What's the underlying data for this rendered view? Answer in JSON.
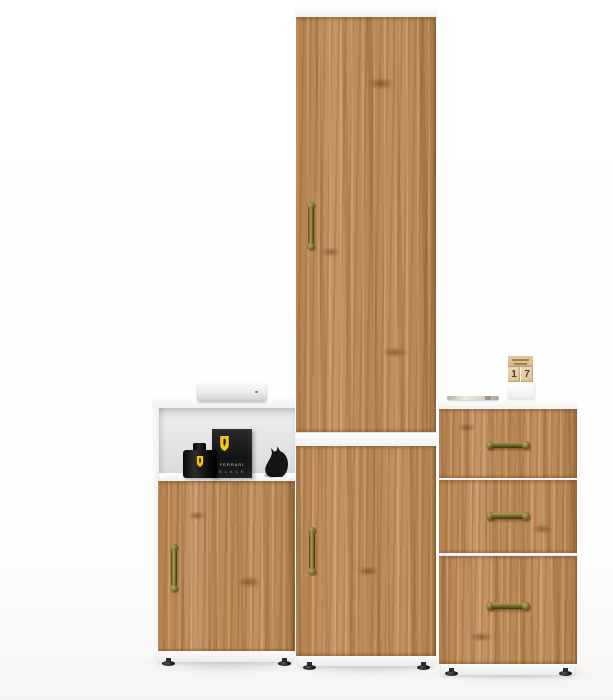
{
  "scene": {
    "description": "Product render of a three-piece golden-oak and white hallway furniture set on a white studio background"
  },
  "palette": {
    "wood_mid": "#b5834e",
    "wood_light": "#c69465",
    "wood_dark": "#8f6539",
    "frame_white": "#f8f8f8",
    "brass_handle": "#6e6226",
    "prop_black": "#141414",
    "shield_yellow": "#f6c60d",
    "background": "#fefefe"
  },
  "furniture": {
    "tall_cabinet": {
      "name": "tall two-door wardrobe cabinet",
      "doors": 2,
      "handle_style": "antique brass, vertical"
    },
    "left_cabinet": {
      "name": "low cabinet with open shelf and single door",
      "handle_style": "antique brass, vertical"
    },
    "drawer_unit": {
      "name": "three-drawer chest",
      "drawers": 3,
      "handle_style": "antique brass, horizontal"
    }
  },
  "props": {
    "media_box": {
      "name": "flat white media box"
    },
    "perfume_box": {
      "line1": "FERRARI",
      "line2": "B L A C K"
    },
    "perfume_bottle": {
      "name": "black perfume bottle with yellow shield label"
    },
    "figurine": {
      "name": "black cat figurine"
    },
    "pen": {
      "name": "pen lying on chest top"
    },
    "cube_calendar": {
      "digits": [
        "1",
        "7"
      ]
    }
  }
}
